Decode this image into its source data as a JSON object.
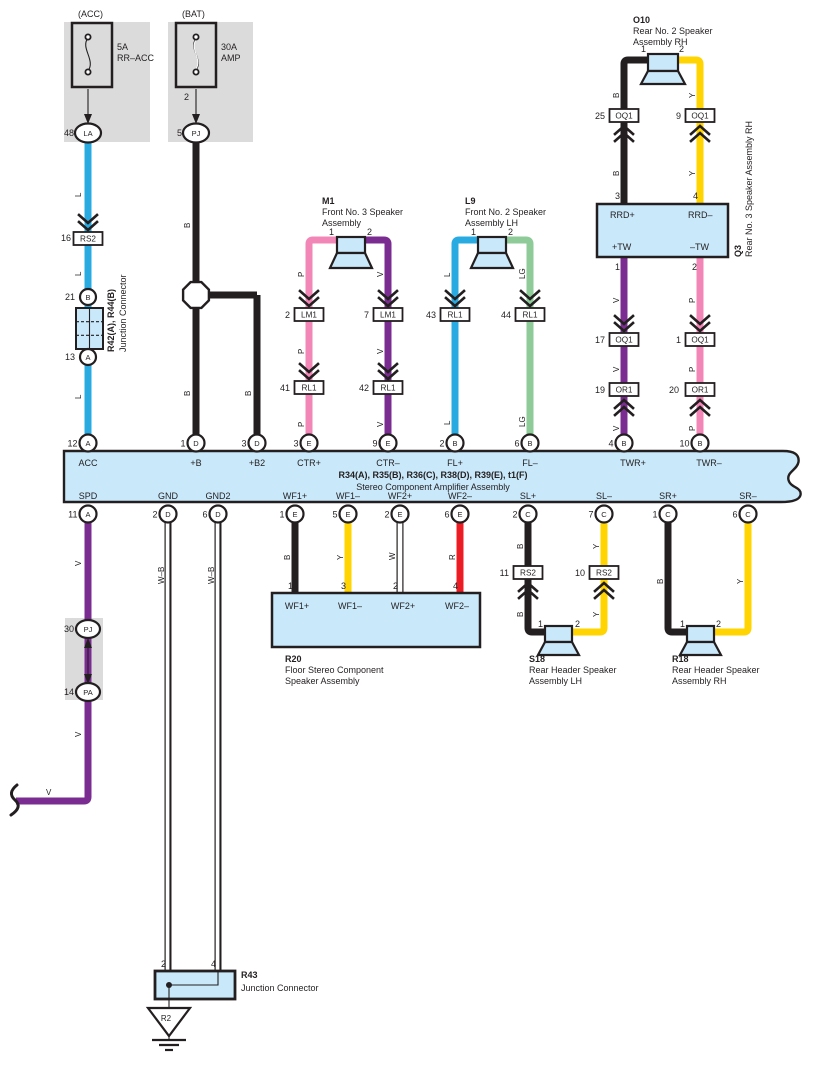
{
  "colors": {
    "blue": "#29abe2",
    "black": "#231f20",
    "pink": "#f287b7",
    "violet": "#7a2c90",
    "green": "#8ecb99",
    "yellow": "#ffd400",
    "red": "#ec1c24",
    "white": "#ffffff",
    "panel": "#c9e8fa",
    "gray": "#dbdbdb"
  },
  "w": {
    "B": "B",
    "L": "L",
    "P": "P",
    "V": "V",
    "LG": "LG",
    "Y": "Y",
    "W": "W",
    "R": "R",
    "WB": "W–B"
  },
  "cn": {
    "RS2": "RS2",
    "LM1": "LM1",
    "RL1": "RL1",
    "OQ1": "OQ1",
    "OR1": "OR1"
  },
  "f": {
    "acc": {
      "h": "(ACC)",
      "a": "5A",
      "n": "RR–ACC",
      "pn": "48",
      "t": "LA"
    },
    "bat": {
      "h": "(BAT)",
      "a": "30A",
      "n": "AMP",
      "p2": "2",
      "pn": "5",
      "t": "PJ"
    }
  },
  "jx": {
    "name": "R42(A), R44(B)",
    "desc": "Junction Connector",
    "p16": "16",
    "p21": "21",
    "tB": "B",
    "p13": "13",
    "tA": "A"
  },
  "sp": {
    "m1": {
      "id": "M1",
      "l1": "Front No. 3 Speaker",
      "l2": "Assembly",
      "p1": "1",
      "p2": "2"
    },
    "l9": {
      "id": "L9",
      "l1": "Front No. 2 Speaker",
      "l2": "Assembly LH",
      "p1": "1",
      "p2": "2"
    },
    "o10": {
      "id": "O10",
      "l1": "Rear No. 2 Speaker",
      "l2": "Assembly RH",
      "p1": "1",
      "p2": "2"
    },
    "s18": {
      "id": "S18",
      "l1": "Rear Header Speaker",
      "l2": "Assembly LH",
      "p1": "1",
      "p2": "2"
    },
    "r18": {
      "id": "R18",
      "l1": "Rear Header Speaker",
      "l2": "Assembly RH",
      "p1": "1",
      "p2": "2"
    }
  },
  "q3": {
    "id": "Q3",
    "desc": "Rear No. 3 Speaker Assembly RH",
    "p3": "3",
    "p4": "4",
    "p1": "1",
    "p2": "2",
    "rrdp": "RRD+",
    "rrdm": "RRD–",
    "twp": "+TW",
    "twm": "–TW"
  },
  "ic": {
    "lm1a": "2",
    "lm1b": "7",
    "rl41": "41",
    "rl42": "42",
    "rl43": "43",
    "rl44": "44",
    "oq25": "25",
    "oq9": "9",
    "oq17": "17",
    "oq1": "1",
    "or19": "19",
    "or20": "20",
    "rs11": "11",
    "rs10": "10"
  },
  "sc": {
    "p30": "30",
    "tPJ": "PJ",
    "p14": "14",
    "tPA": "PA"
  },
  "amp": {
    "name": "R34(A), R35(B), R36(C), R38(D), R39(E), t1(F)",
    "desc": "Stereo Component Amplifier Assembly",
    "top": [
      {
        "num": "12",
        "term": "A",
        "label": "ACC"
      },
      {
        "num": "1",
        "term": "D",
        "label": "+B"
      },
      {
        "num": "3",
        "term": "D",
        "label": "+B2"
      },
      {
        "num": "3",
        "term": "E",
        "label": "CTR+"
      },
      {
        "num": "9",
        "term": "E",
        "label": "CTR–"
      },
      {
        "num": "2",
        "term": "B",
        "label": "FL+"
      },
      {
        "num": "6",
        "term": "B",
        "label": "FL–"
      },
      {
        "num": "4",
        "term": "B",
        "label": "TWR+"
      },
      {
        "num": "10",
        "term": "B",
        "label": "TWR–"
      }
    ],
    "bottom": [
      {
        "num": "11",
        "term": "A",
        "label": "SPD"
      },
      {
        "num": "2",
        "term": "D",
        "label": "GND"
      },
      {
        "num": "6",
        "term": "D",
        "label": "GND2"
      },
      {
        "num": "1",
        "term": "E",
        "label": "WF1+"
      },
      {
        "num": "5",
        "term": "E",
        "label": "WF1–"
      },
      {
        "num": "2",
        "term": "E",
        "label": "WF2+"
      },
      {
        "num": "6",
        "term": "E",
        "label": "WF2–"
      },
      {
        "num": "2",
        "term": "C",
        "label": "SL+"
      },
      {
        "num": "7",
        "term": "C",
        "label": "SL–"
      },
      {
        "num": "1",
        "term": "C",
        "label": "SR+"
      },
      {
        "num": "6",
        "term": "C",
        "label": "SR–"
      }
    ]
  },
  "r20": {
    "id": "R20",
    "l1": "Floor Stereo Component",
    "l2": "Speaker Assembly",
    "pins": [
      {
        "num": "1",
        "label": "WF1+"
      },
      {
        "num": "3",
        "label": "WF1–"
      },
      {
        "num": "2",
        "label": "WF2+"
      },
      {
        "num": "4",
        "label": "WF2–"
      }
    ]
  },
  "r43": {
    "id": "R43",
    "desc": "Junction Connector",
    "p2": "2",
    "p4": "4"
  },
  "gnd": {
    "id": "R2"
  }
}
